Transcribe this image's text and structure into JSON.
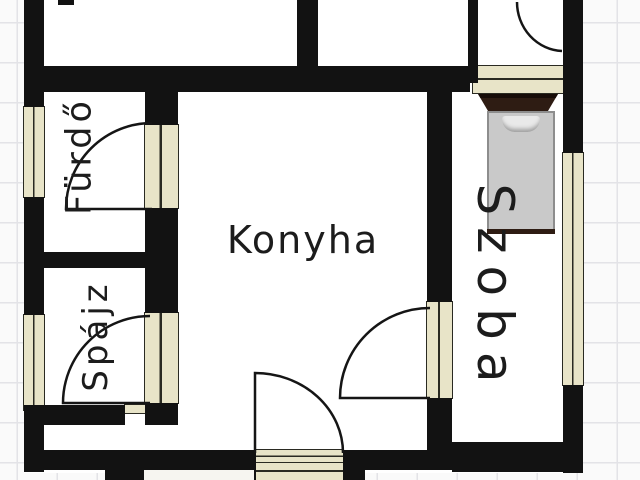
{
  "plan": {
    "type": "floor-plan",
    "rooms": [
      {
        "id": "furdo",
        "label": "Fürdő",
        "label_orientation": "rotated-ccw"
      },
      {
        "id": "spajz",
        "label": "Spájz",
        "label_orientation": "rotated-ccw"
      },
      {
        "id": "konyha",
        "label": "Konyha",
        "label_orientation": "horizontal"
      },
      {
        "id": "szoba",
        "label": "Szoba",
        "label_orientation": "rotated-cw"
      }
    ],
    "doors": [
      {
        "between": [
          "Fürdő",
          "Konyha"
        ],
        "swing": "into Fürdő"
      },
      {
        "between": [
          "Spájz",
          "Konyha"
        ],
        "swing": "into Spájz"
      },
      {
        "between": [
          "Konyha",
          "Szoba"
        ],
        "swing": "into Konyha"
      },
      {
        "between": [
          "Konyha",
          "outside"
        ],
        "swing": "into Konyha",
        "note": "entrance with steps"
      },
      {
        "between": [
          "hall",
          "top room"
        ],
        "swing": "into top room",
        "note": "cut off at top edge"
      }
    ],
    "windows": [
      {
        "wall": "left",
        "count": 2
      },
      {
        "wall": "right",
        "count": 1
      }
    ],
    "furniture": [
      {
        "name": "bed",
        "room": "Szoba"
      }
    ],
    "colors": {
      "wall": "#121212",
      "opening_fill": "#e8e4c8",
      "room_fill": "#ffffff",
      "paper_background": "#fafafa",
      "paper_grid": "#e3e3e7",
      "text": "#1c1c1c",
      "bed_frame": "#2e1c13",
      "bed_mattress": "#c9c9c9",
      "bed_pillow": "#e9e9e9"
    }
  }
}
